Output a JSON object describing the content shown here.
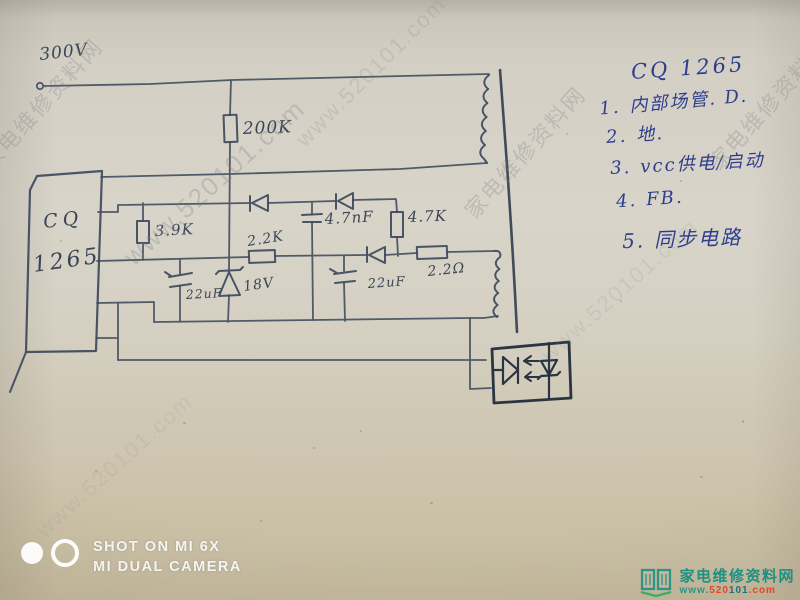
{
  "watermark": {
    "site_name": "家电维修资料网",
    "site_url": "www.520101.com"
  },
  "circuit": {
    "supply_label": "300V",
    "chip": {
      "line1": "CQ",
      "line2": "1265"
    },
    "labels": {
      "r200k": "200K",
      "r3k9": "3.9K",
      "r2k2": "2.2K",
      "c4n7": "4.7nF",
      "r4k7": "4.7K",
      "c22uf_a": "22uF",
      "zener": "18V",
      "c22uf_b": "22uF",
      "r2r2": "2.2Ω"
    }
  },
  "annotation": {
    "title": "CQ 1265",
    "pins": [
      {
        "num": "1.",
        "desc": "内部场管. D."
      },
      {
        "num": "2.",
        "desc": "地."
      },
      {
        "num": "3.",
        "desc": "vcc供电/启动"
      },
      {
        "num": "4.",
        "desc": "FB."
      },
      {
        "num": "5.",
        "desc": "同步电路"
      }
    ]
  },
  "camera_badge": {
    "line1": "SHOT ON MI 6X",
    "line2": "MI DUAL CAMERA"
  },
  "site_logo": {
    "name": "家电维修资料网",
    "url_www": "www.",
    "url_520": "520",
    "url_101": "101",
    "url_com": ".com"
  },
  "colors": {
    "ink": "#3e4a5c",
    "blue_ink": "#2d3e8e",
    "logo_teal": "#1f8f82",
    "logo_red": "#e2452c"
  }
}
